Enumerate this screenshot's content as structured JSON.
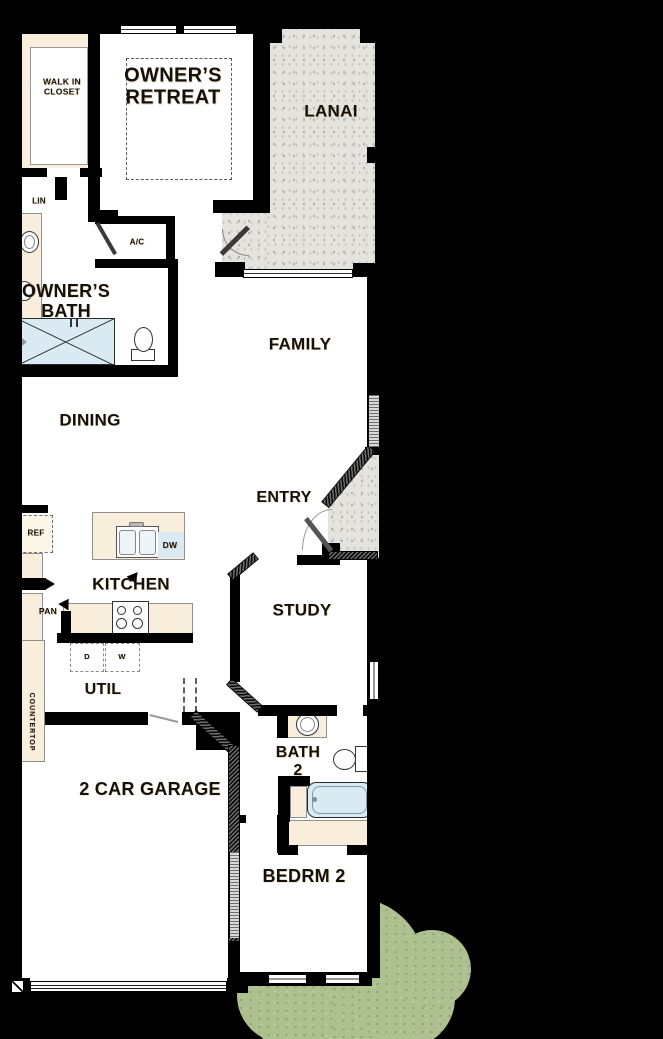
{
  "title": "single-story floor plan",
  "colors": {
    "background": "#000000",
    "floor": "#ffffff",
    "wall": "#000000",
    "casework": "#f8eedb",
    "water": "#d9eaf3",
    "concrete": "#e4e3de",
    "shrub": "#aec08f",
    "label": "#151009"
  },
  "rooms": {
    "walk_in_closet": "WALK IN\nCLOSET",
    "owners_retreat": "OWNER’S\nRETREAT",
    "lanai": "LANAI",
    "lin": "LIN",
    "ac": "A/C",
    "owners_bath": "OWNER’S\nBATH",
    "family": "FAMILY",
    "dining": "DINING",
    "entry": "ENTRY",
    "kitchen": "KITCHEN",
    "study": "STUDY",
    "util": "UTIL",
    "bath_2": "BATH\n2",
    "garage": "2 CAR GARAGE",
    "bedrm_2": "BEDRM 2"
  },
  "labels": {
    "ref": "REF",
    "pan": "PAN",
    "dw": "DW",
    "dryer": "D",
    "washer": "W",
    "countertop": "COUNTERTOP"
  }
}
